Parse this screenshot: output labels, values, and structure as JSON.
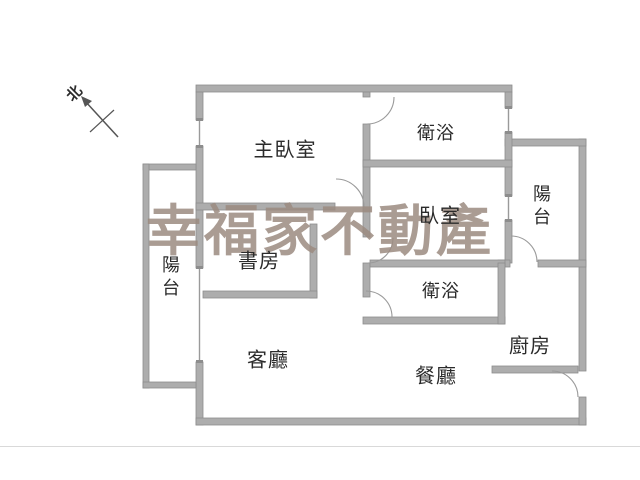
{
  "floorplan": {
    "rooms": {
      "master_bedroom": {
        "label": "主臥室"
      },
      "bathroom_top": {
        "label": "衛浴"
      },
      "bedroom": {
        "label": "臥室"
      },
      "balcony_right": {
        "label": "陽台"
      },
      "balcony_left": {
        "label": "陽台"
      },
      "study": {
        "label": "書房"
      },
      "living_room": {
        "label": "客廳"
      },
      "dining_room": {
        "label": "餐廳"
      },
      "kitchen": {
        "label": "廚房"
      },
      "bathroom_bottom": {
        "label": "衛浴"
      }
    },
    "compass": {
      "label": "北"
    }
  },
  "watermark": {
    "text": "幸福家不動產",
    "color": "#9c8b81"
  },
  "colors": {
    "wall": "#adadad",
    "wall_edge": "#8d8d8d",
    "door_arc": "#9a9a9a",
    "window_line": "#9a9a9a",
    "compass_ink": "#555555",
    "label": "#2b2b2b",
    "background": "#ffffff",
    "footer_line": "#d9d9d9"
  }
}
